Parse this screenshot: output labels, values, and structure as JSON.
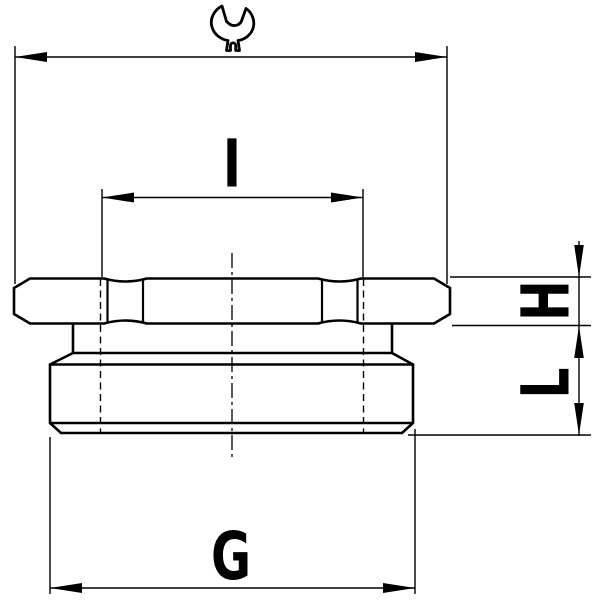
{
  "drawing": {
    "background_color": "#ffffff",
    "line_color": "#000000",
    "dimensions": [
      {
        "id": "spanner-width",
        "icon": "wrench-icon",
        "label": ""
      },
      {
        "id": "inner-width",
        "label": "I"
      },
      {
        "id": "flange-height",
        "label": "H"
      },
      {
        "id": "thread-length",
        "label": "L"
      },
      {
        "id": "thread-size",
        "label": "G"
      }
    ]
  }
}
